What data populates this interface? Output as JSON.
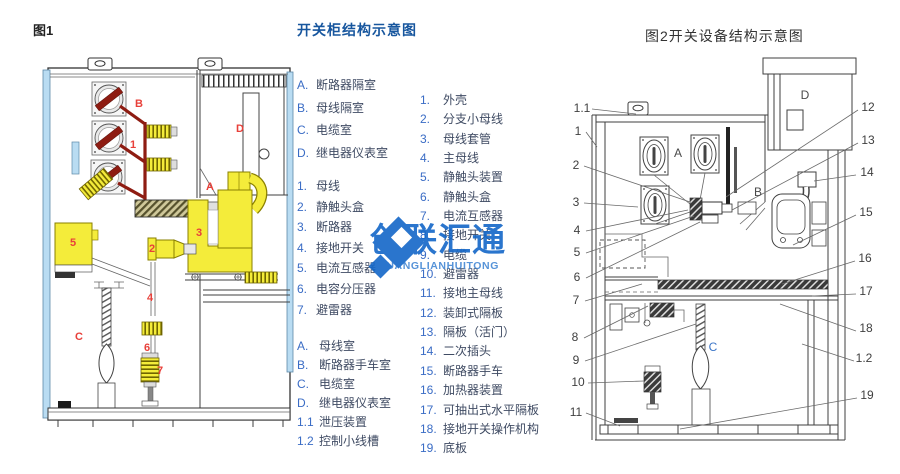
{
  "fig1": {
    "caption": "图1",
    "rooms": {
      "a": "A",
      "b": "B",
      "c": "C",
      "d": "D"
    },
    "parts": [
      "1",
      "2",
      "3",
      "4",
      "5",
      "6",
      "7"
    ]
  },
  "legend": {
    "title": "开关柜结构示意图",
    "col1_compartments": [
      {
        "m": "A.",
        "t": "断路器隔室"
      },
      {
        "m": "B.",
        "t": "母线隔室"
      },
      {
        "m": "C.",
        "t": "电缆室"
      },
      {
        "m": "D.",
        "t": "继电器仪表室"
      }
    ],
    "col1_parts": [
      {
        "m": "1.",
        "t": "母线"
      },
      {
        "m": "2.",
        "t": "静触头盒"
      },
      {
        "m": "3.",
        "t": "断路器"
      },
      {
        "m": "4.",
        "t": "接地开关"
      },
      {
        "m": "5.",
        "t": "电流互感器"
      },
      {
        "m": "6.",
        "t": "电容分压器"
      },
      {
        "m": "7.",
        "t": "避雷器"
      }
    ],
    "col1_rooms": [
      {
        "m": "A.",
        "t": "母线室"
      },
      {
        "m": "B.",
        "t": "断路器手车室"
      },
      {
        "m": "C.",
        "t": "电缆室"
      },
      {
        "m": "D.",
        "t": "继电器仪表室"
      },
      {
        "m": "1.1",
        "t": "泄压装置"
      },
      {
        "m": "1.2",
        "t": "控制小线槽"
      }
    ],
    "col2_parts": [
      {
        "m": "1.",
        "t": "外壳"
      },
      {
        "m": "2.",
        "t": "分支小母线"
      },
      {
        "m": "3.",
        "t": "母线套管"
      },
      {
        "m": "4.",
        "t": "主母线"
      },
      {
        "m": "5.",
        "t": "静触头装置"
      },
      {
        "m": "6.",
        "t": "静触头盒"
      },
      {
        "m": "7.",
        "t": "电流互感器"
      },
      {
        "m": "8.",
        "t": "接地开关"
      },
      {
        "m": "9.",
        "t": "电缆"
      },
      {
        "m": "10.",
        "t": "避雷器"
      },
      {
        "m": "11.",
        "t": "接地主母线"
      },
      {
        "m": "12.",
        "t": "装卸式隔板"
      },
      {
        "m": "13.",
        "t": "隔板（活门）"
      },
      {
        "m": "14.",
        "t": "二次插头"
      },
      {
        "m": "15.",
        "t": "断路器手车"
      },
      {
        "m": "16.",
        "t": "加热器装置"
      },
      {
        "m": "17.",
        "t": "可抽出式水平隔板"
      },
      {
        "m": "18.",
        "t": "接地开关操作机构"
      },
      {
        "m": "19.",
        "t": "底板"
      }
    ]
  },
  "fig2": {
    "caption": "图2开关设备结构示意图",
    "left_labels": [
      "1.1",
      "1",
      "2",
      "3",
      "4",
      "5",
      "6",
      "7",
      "8",
      "9",
      "10",
      "11"
    ],
    "right_labels": [
      "12",
      "13",
      "14",
      "15",
      "16",
      "17",
      "18",
      "1.2",
      "19"
    ],
    "rooms": {
      "a": "A",
      "b": "B",
      "c": "C",
      "d": "D"
    }
  },
  "watermark": {
    "cn": "创联汇通",
    "en": "CHUANGLIANHUITONG"
  },
  "colors": {
    "title_blue": "#17569e",
    "list_marker_blue": "#3a6cc5",
    "list_text": "#3f4b63",
    "fig1_label_red": "#e8403a",
    "busbar_dark_red": "#8e1c12",
    "component_yellow": "#f4ec3a",
    "panel_light_blue": "#b9dcf2",
    "watermark_blue": "#1467c8",
    "line_gray": "#3f3f3f"
  }
}
